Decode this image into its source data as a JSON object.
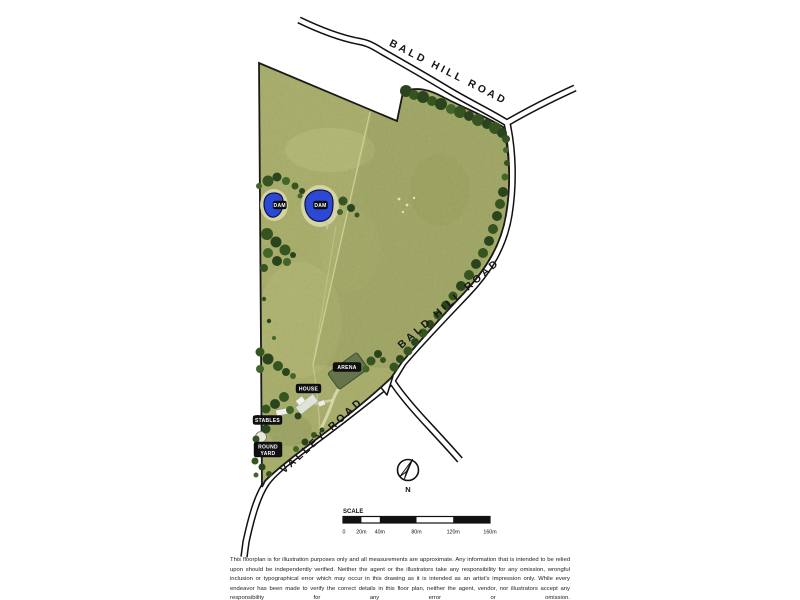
{
  "map": {
    "roads": {
      "bald_hill_top": "BALD HILL ROAD",
      "bald_hill_right": "BALD HILL ROAD",
      "valley": "VALLEY ROAD"
    },
    "features": {
      "dam1": "DAM",
      "dam2": "DAM",
      "arena": "ARENA",
      "house": "HOUSE",
      "stables": "STABLES",
      "round_yard_line1": "ROUND",
      "round_yard_line2": "YARD"
    },
    "compass": {
      "north_label": "N"
    },
    "scalebar": {
      "title": "SCALE",
      "ticks": [
        "0",
        "20m",
        "40m",
        "80m",
        "120m",
        "160m"
      ]
    },
    "colors": {
      "pasture": "#a6ab68",
      "trees_dark": "#2a451d",
      "dam_blue": "#2b49d6",
      "road_line": "#111111",
      "label_bg": "#101010",
      "label_text": "#ffffff"
    }
  },
  "disclaimer": "This floorplan is for illustration purposes only and all measurements are approximate. Any information that is intended to be relied upon should be independently verified. Neither the agent or the illustrators take any responsibility for any omission, wrongful inclusion or typographical error which may occur in this drawing as it is intended as an artist's impression only. While every endeavor has been made to verify the correct details in this floor plan, neither the agent, vendor, nor illustrators accept any responsibility for any error or omission."
}
